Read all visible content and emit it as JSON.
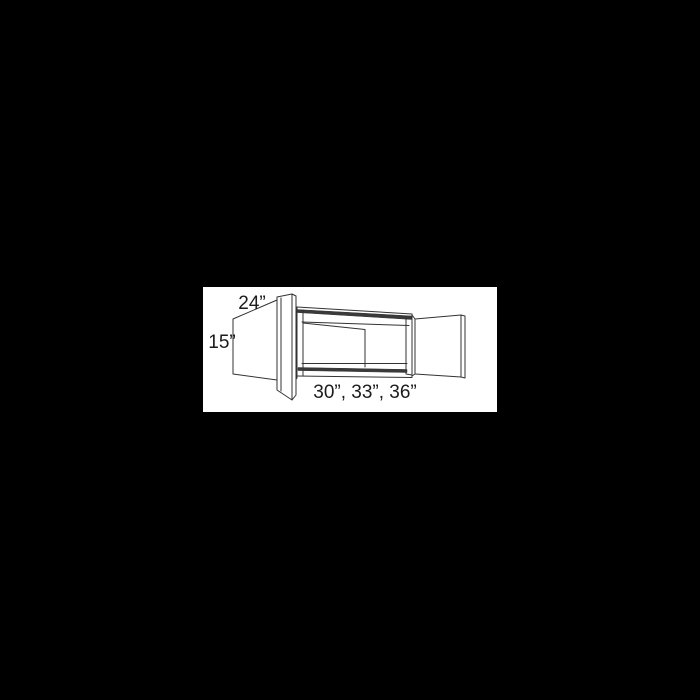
{
  "page": {
    "background_color": "#000000",
    "canvas_color": "#ffffff"
  },
  "diagram": {
    "description": "wall-cabinet-with-open-doors-line-drawing",
    "labels": {
      "depth": "24”",
      "height": "15”",
      "widths": "30”, 33”, 36”"
    },
    "colors": {
      "line": "#333333",
      "shade": "#3a3a3a",
      "text": "#1c1c1c",
      "face": "#ffffff"
    }
  }
}
